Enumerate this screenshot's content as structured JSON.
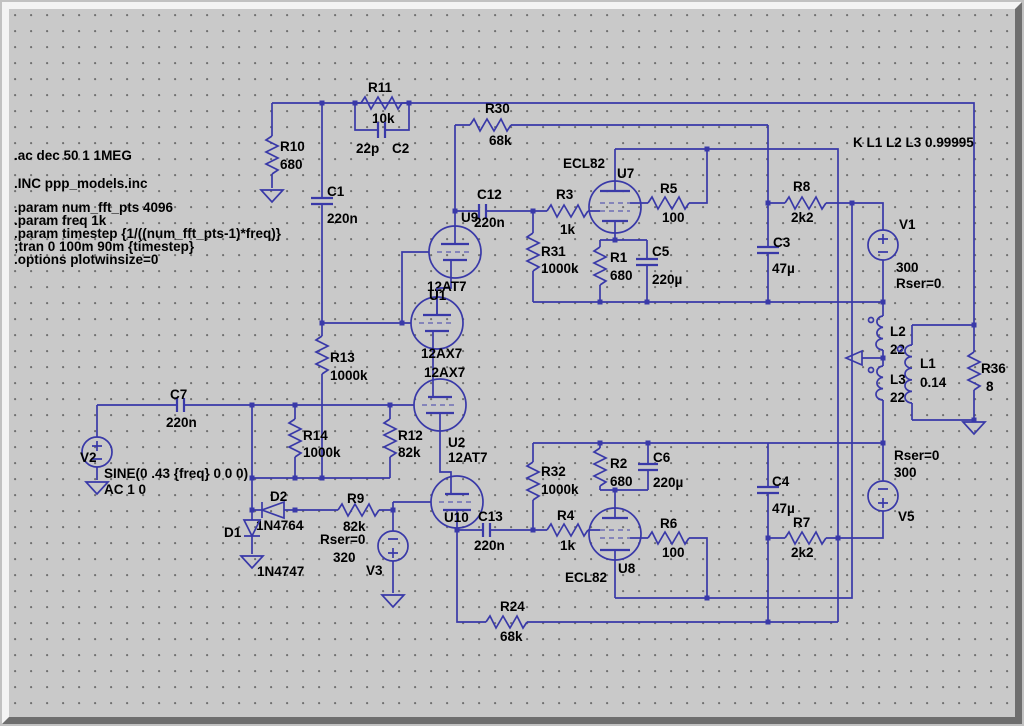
{
  "directives": {
    "lines": [
      ".ac dec 50 1 1MEG",
      ".INC ppp_models.inc",
      ".param num_fft_pts 4096",
      ".param freq 1k",
      ".param timestep {1/((num_fft_pts-1)*freq)}",
      ";tran 0 100m 90m {timestep}",
      ".options plotwinsize=0"
    ]
  },
  "k_statement": "K L1 L2 L3 0.99995",
  "components": {
    "r10": {
      "ref": "R10",
      "value": "680"
    },
    "r11": {
      "ref": "R11",
      "value": "10k"
    },
    "c2": {
      "ref": "C2",
      "value": "22p"
    },
    "c1": {
      "ref": "C1",
      "value": "220n"
    },
    "r13": {
      "ref": "R13",
      "value": "1000k"
    },
    "r14": {
      "ref": "R14",
      "value": "1000k"
    },
    "r12": {
      "ref": "R12",
      "value": "82k"
    },
    "c7": {
      "ref": "C7",
      "value": "220n"
    },
    "v2": {
      "ref": "V2",
      "sine": "SINE(0 .43 {freq} 0 0 0)",
      "ac": "AC 1 0"
    },
    "d2": {
      "ref": "D2",
      "model": "1N4764"
    },
    "d1": {
      "ref": "D1",
      "model": "1N4747"
    },
    "r9": {
      "ref": "R9",
      "value": "82k"
    },
    "v3": {
      "ref": "V3",
      "rser": "Rser=0",
      "value": "320"
    },
    "u9": {
      "ref": "U9",
      "type": "12AT7"
    },
    "u1": {
      "ref": "U1",
      "type": "12AX7"
    },
    "u2": {
      "ref": "U2",
      "type": "12AX7"
    },
    "u10": {
      "ref": "U10",
      "type": "12AT7"
    },
    "c12": {
      "ref": "C12",
      "value": "220n"
    },
    "c13": {
      "ref": "C13",
      "value": "220n"
    },
    "r3": {
      "ref": "R3",
      "value": "1k"
    },
    "r4": {
      "ref": "R4",
      "value": "1k"
    },
    "r31": {
      "ref": "R31",
      "value": "1000k"
    },
    "r32": {
      "ref": "R32",
      "value": "1000k"
    },
    "u7": {
      "ref": "U7",
      "type": "ECL82"
    },
    "u8": {
      "ref": "U8",
      "type": "ECL82"
    },
    "r5": {
      "ref": "R5",
      "value": "100"
    },
    "r6": {
      "ref": "R6",
      "value": "100"
    },
    "r1": {
      "ref": "R1",
      "value": "680"
    },
    "r2": {
      "ref": "R2",
      "value": "680"
    },
    "c5": {
      "ref": "C5",
      "value": "220µ"
    },
    "c6": {
      "ref": "C6",
      "value": "220µ"
    },
    "r30": {
      "ref": "R30",
      "value": "68k"
    },
    "r24": {
      "ref": "R24",
      "value": "68k"
    },
    "r8": {
      "ref": "R8",
      "value": "2k2"
    },
    "r7": {
      "ref": "R7",
      "value": "2k2"
    },
    "c3": {
      "ref": "C3",
      "value": "47µ"
    },
    "c4": {
      "ref": "C4",
      "value": "47µ"
    },
    "v1": {
      "ref": "V1",
      "value": "300",
      "rser": "Rser=0"
    },
    "v5": {
      "ref": "V5",
      "value": "300",
      "rser": "Rser=0"
    },
    "l2": {
      "ref": "L2",
      "value": "22"
    },
    "l3": {
      "ref": "L3",
      "value": "22"
    },
    "l1": {
      "ref": "L1",
      "value": "0.14"
    },
    "r36": {
      "ref": "R36",
      "value": "8"
    }
  }
}
